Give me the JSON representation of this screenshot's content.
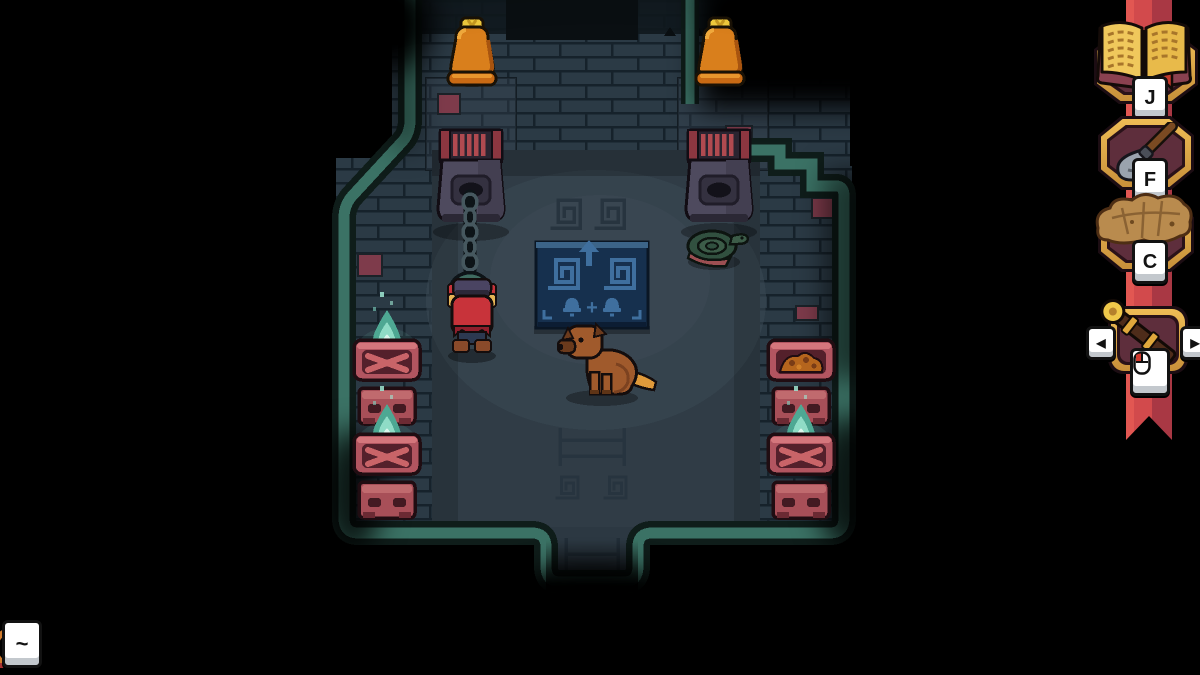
{
  "hud": {
    "hotbar": {
      "slots": [
        {
          "id": "journal",
          "icon": "journal-book-icon",
          "key_label": "J"
        },
        {
          "id": "shovel",
          "icon": "shovel-icon",
          "key_label": "F"
        },
        {
          "id": "map",
          "icon": "crumpled-map-icon",
          "key_label": "C"
        },
        {
          "id": "equipped-item",
          "icon": "torch-club-icon",
          "key_icon": "mouse-left-click-icon",
          "prev_label": "◀",
          "next_label": "▶"
        }
      ],
      "ribbon_color": "#d24a4c"
    },
    "console_key_label": "~"
  },
  "scene": {
    "sign": {
      "plus_symbol": "+",
      "symbols": [
        "square-spiral",
        "square-spiral",
        "arrow-up",
        "bell",
        "plus",
        "bell"
      ]
    },
    "entities": [
      {
        "name": "bell-left"
      },
      {
        "name": "bell-right"
      },
      {
        "name": "winch-left"
      },
      {
        "name": "winch-right"
      },
      {
        "name": "chain-with-ring"
      },
      {
        "name": "player-character"
      },
      {
        "name": "dog-companion"
      },
      {
        "name": "puzzle-sign"
      },
      {
        "name": "coiled-snake"
      },
      {
        "name": "brazier-west-top",
        "lit": true
      },
      {
        "name": "brazier-west-bottom",
        "lit": true
      },
      {
        "name": "brazier-east-top",
        "lit": false
      },
      {
        "name": "brazier-east-bottom",
        "lit": true
      }
    ],
    "braziers": {
      "lit_count": 3,
      "unlit_count": 1
    }
  },
  "colors": {
    "outline_teal": "#3b7265",
    "wall": "#2b3a45",
    "wall_line": "#16222b",
    "floor": "#303c46",
    "accent_brick": "#7e3b4b",
    "ribbon_red": "#d24a4c",
    "ribbon_dark": "#a93844",
    "gold": "#d9a13f",
    "badge_maroon": "#5e2e3c",
    "flame_teal": "#8fdcc6",
    "sign_blue": "#16304e",
    "sign_glyph_blue": "#3f6f9e",
    "bell_orange": "#d97f1c",
    "keycap": "#ffffff"
  }
}
